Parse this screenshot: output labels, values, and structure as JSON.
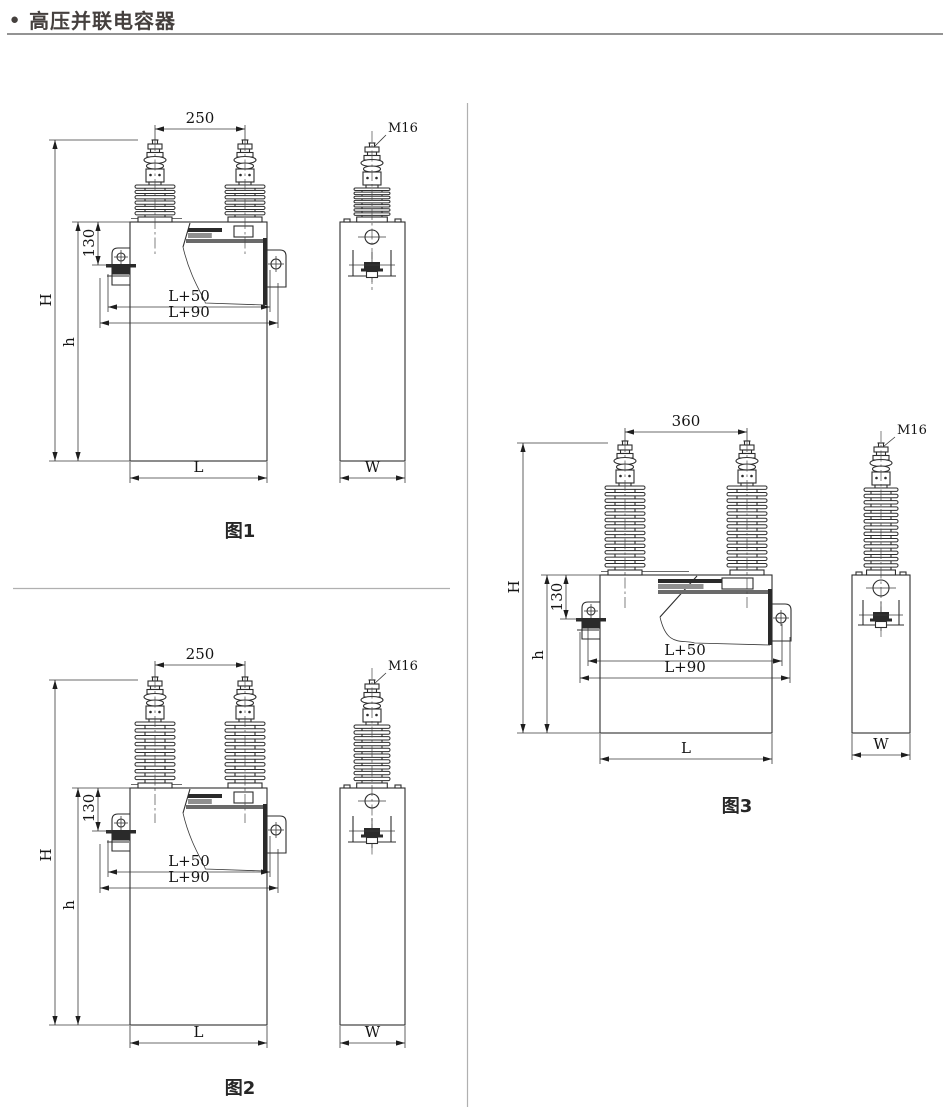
{
  "header": {
    "bullet": "●",
    "title": "高压并联电容器"
  },
  "figures": [
    {
      "caption": "图1",
      "dims": {
        "span": "250",
        "m16": "M16",
        "offset": "130",
        "H": "H",
        "h": "h",
        "l50": "L+50",
        "l90": "L+90",
        "L": "L",
        "W": "W"
      }
    },
    {
      "caption": "图2",
      "dims": {
        "span": "250",
        "m16": "M16",
        "offset": "130",
        "H": "H",
        "h": "h",
        "l50": "L+50",
        "l90": "L+90",
        "L": "L",
        "W": "W"
      }
    },
    {
      "caption": "图3",
      "dims": {
        "span": "360",
        "m16": "M16",
        "offset": "130",
        "H": "H",
        "h": "h",
        "l50": "L+50",
        "l90": "L+90",
        "L": "L",
        "W": "W"
      }
    }
  ]
}
